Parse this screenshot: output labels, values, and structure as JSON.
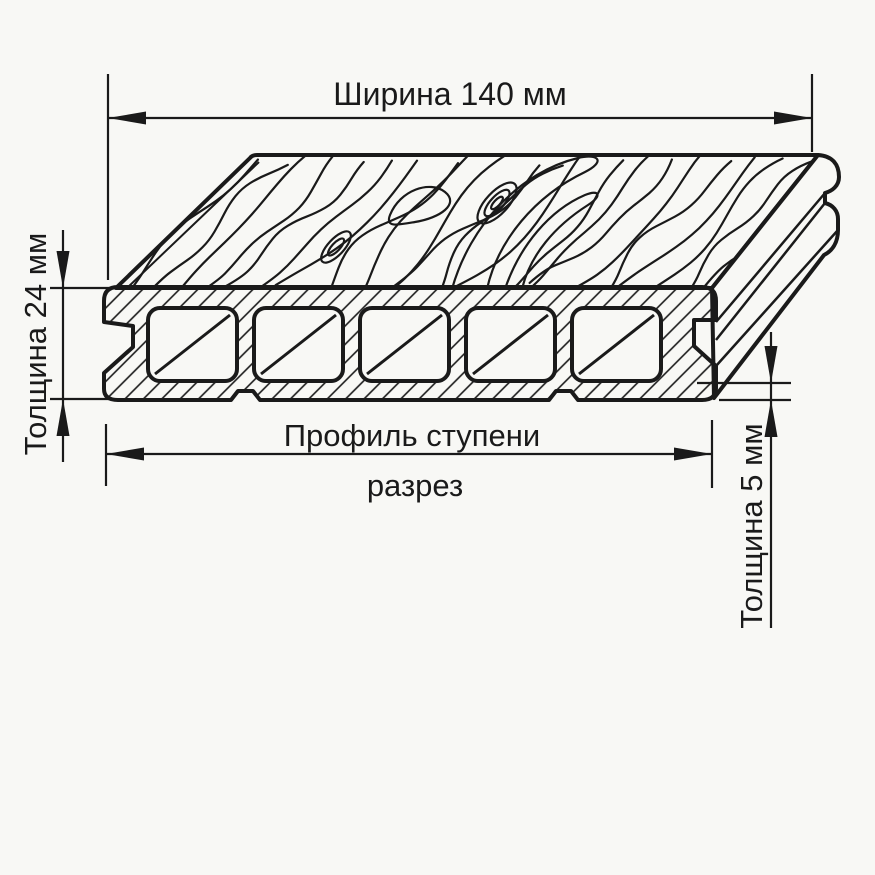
{
  "drawing": {
    "dimensions": {
      "width": {
        "label": "Ширина 140 мм",
        "value_mm": 140
      },
      "board_thickness": {
        "label": "Толщина 24 мм",
        "value_mm": 24
      },
      "lip_thickness": {
        "label": "Толщина 5 мм",
        "value_mm": 5
      },
      "profile": {
        "title": "Профиль ступени",
        "subtitle": "разрез"
      }
    },
    "board": {
      "hollow_channels": 5
    },
    "colors": {
      "background": "#f8f8f5",
      "line": "#1a1a1a"
    }
  }
}
